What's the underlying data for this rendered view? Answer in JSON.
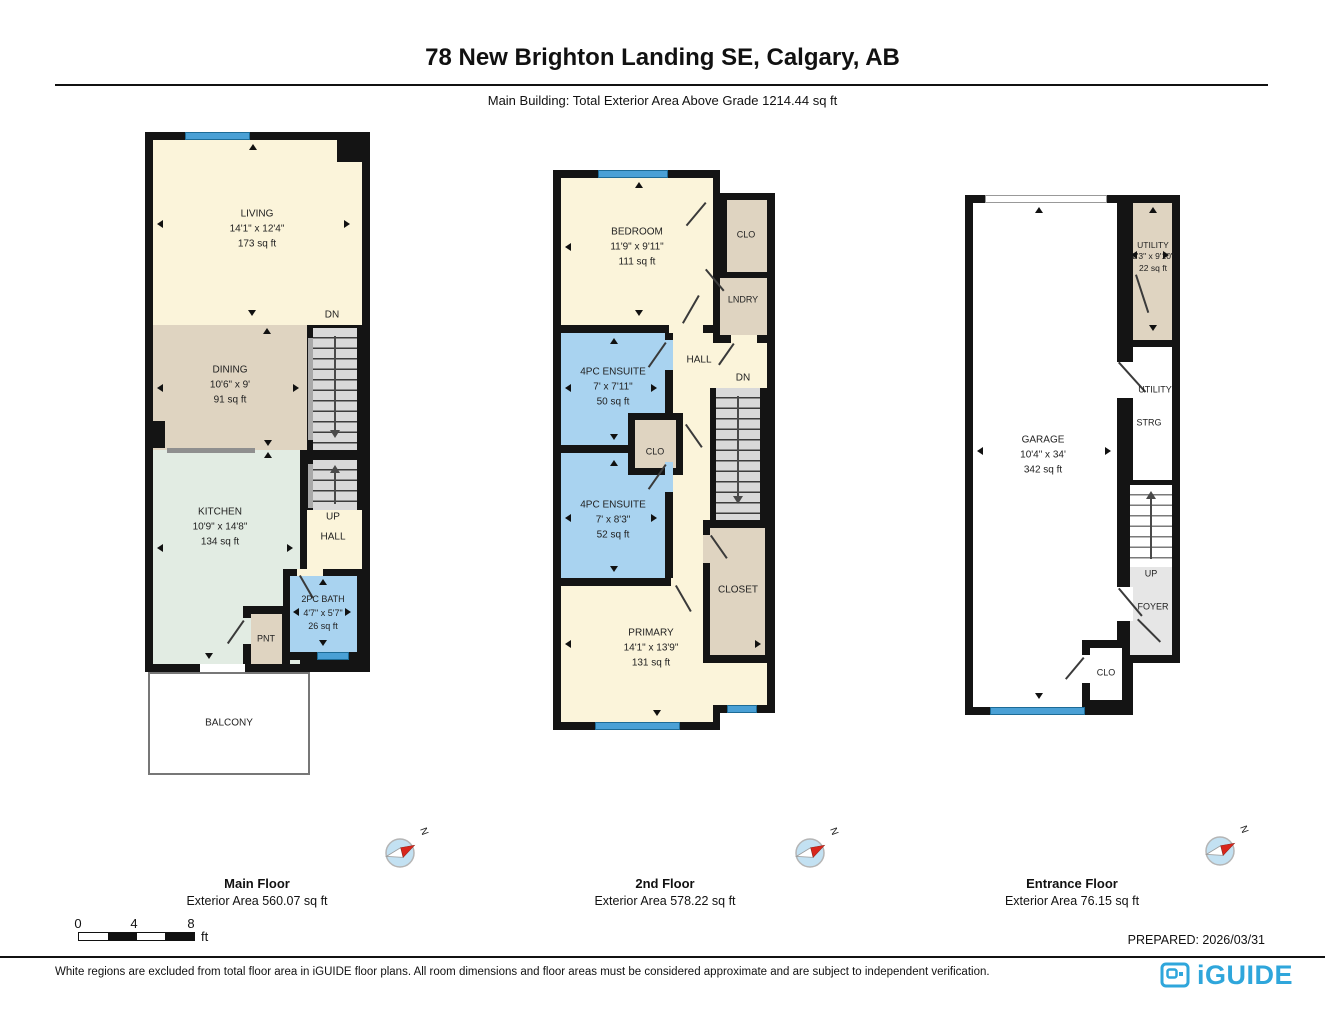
{
  "header": {
    "title": "78 New Brighton Landing SE, Calgary, AB",
    "subtitle": "Main Building: Total Exterior Area Above Grade 1214.44 sq ft"
  },
  "floors": [
    {
      "label": "Main Floor",
      "area_label": "Exterior Area 560.07 sq ft",
      "rooms": {
        "living": {
          "name": "LIVING",
          "dims": "14'1\" x 12'4\"",
          "area": "173 sq ft"
        },
        "dining": {
          "name": "DINING",
          "dims": "10'6\" x 9'",
          "area": "91 sq ft"
        },
        "kitchen": {
          "name": "KITCHEN",
          "dims": "10'9\" x 14'8\"",
          "area": "134 sq ft"
        },
        "bath": {
          "name": "2PC BATH",
          "dims": "4'7\" x 5'7\"",
          "area": "26 sq ft"
        },
        "pantry": "PNT",
        "balcony": "BALCONY",
        "hall": "HALL",
        "up": "UP",
        "dn": "DN"
      }
    },
    {
      "label": "2nd Floor",
      "area_label": "Exterior Area 578.22 sq ft",
      "rooms": {
        "bedroom": {
          "name": "BEDROOM",
          "dims": "11'9\" x 9'11\"",
          "area": "111 sq ft"
        },
        "ensuite1": {
          "name": "4PC ENSUITE",
          "dims": "7' x 7'11\"",
          "area": "50 sq ft"
        },
        "ensuite2": {
          "name": "4PC ENSUITE",
          "dims": "7' x 8'3\"",
          "area": "52 sq ft"
        },
        "primary": {
          "name": "PRIMARY",
          "dims": "14'1\" x 13'9\"",
          "area": "131 sq ft"
        },
        "clo_top": "CLO",
        "laundry": "LNDRY",
        "hall": "HALL",
        "dn": "DN",
        "clo_mid": "CLO",
        "closet": "CLOSET"
      }
    },
    {
      "label": "Entrance Floor",
      "area_label": "Exterior Area 76.15 sq ft",
      "rooms": {
        "garage": {
          "name": "GARAGE",
          "dims": "10'4\" x 34'",
          "area": "342 sq ft"
        },
        "utility_top": {
          "name": "UTILITY",
          "dims": "2'3\" x 9'10\"",
          "area": "22 sq ft"
        },
        "utility": "UTILITY",
        "storage": "STRG",
        "up": "UP",
        "foyer": "FOYER",
        "clo": "CLO"
      }
    }
  ],
  "compass": {
    "north_label": "N"
  },
  "scale_bar": {
    "ticks": [
      "0",
      "4",
      "8"
    ],
    "unit": "ft"
  },
  "prepared": "PREPARED: 2026/03/31",
  "disclaimer": "White regions are excluded from total floor area in iGUIDE floor plans. All room dimensions and floor areas must be considered approximate and are subject to independent verification.",
  "brand": {
    "logo_text": "iGUIDE"
  },
  "colors": {
    "room_cream": "#FBF4DA",
    "room_tan": "#DFD4C1",
    "room_mint": "#E2ECE3",
    "room_bath_blue": "#A9D3F0",
    "window_blue": "#4AA0D5",
    "stair_gray": "#D9D9D9",
    "foyer_gray": "#E6E6E6",
    "wall_black": "#141414",
    "logo_blue": "#2FA6DB",
    "compass_red": "#D8261C"
  }
}
